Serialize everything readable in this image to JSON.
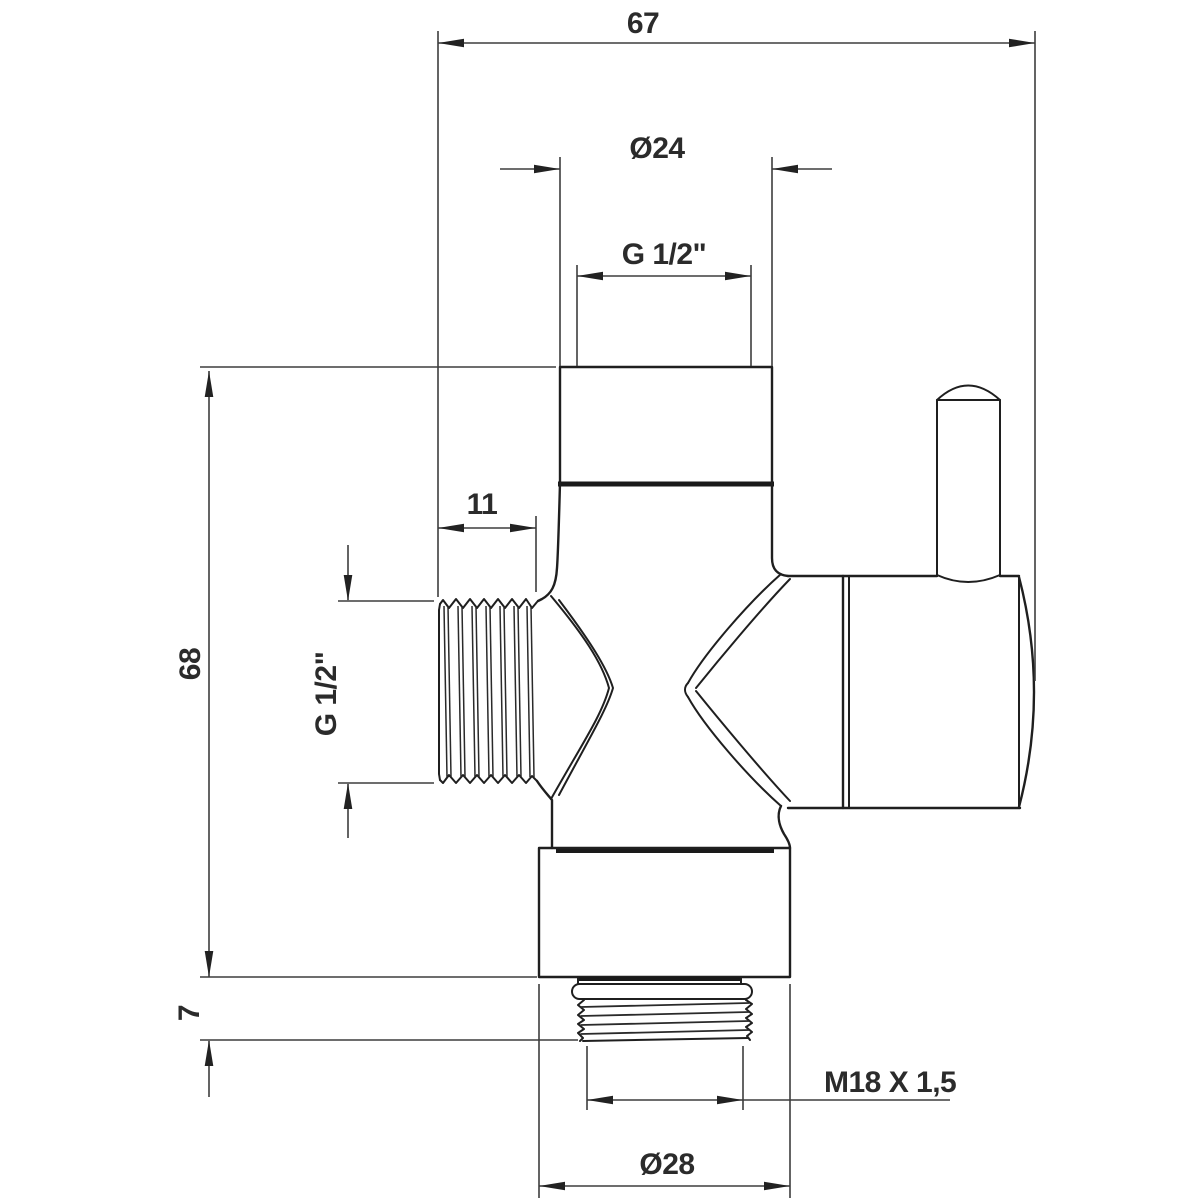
{
  "drawing": {
    "background_color": "#ffffff",
    "line_color": "#1f1f1f",
    "dimension_color": "#3d3d3d",
    "dimensions": {
      "overall_width": {
        "label": "67"
      },
      "top_port_outer_diameter": {
        "label": "Ø24"
      },
      "top_port_thread": {
        "label": "G 1/2\""
      },
      "side_thread_length": {
        "label": "11"
      },
      "overall_height": {
        "label": "68"
      },
      "side_port_thread": {
        "label": "G 1/2\""
      },
      "bottom_collar_height": {
        "label": "7"
      },
      "bottom_thread_spec": {
        "label": "M18 X 1,5"
      },
      "bottom_nut_diameter": {
        "label": "Ø28"
      }
    }
  }
}
